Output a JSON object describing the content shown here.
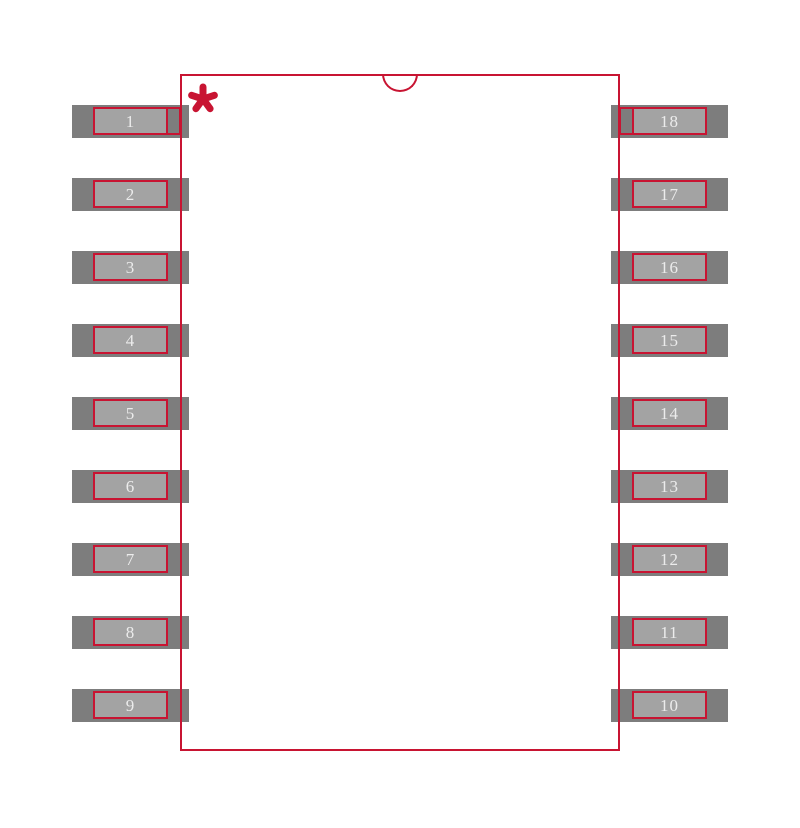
{
  "figure": {
    "kind": "ic-footprint-land-pattern",
    "description": "18-pin dual-row surface mount package footprint with index notch and pin 1 asterisk marker",
    "pin1_marker": "asterisk",
    "colors": {
      "outline_red": "#c81432",
      "pad_outer_gray": "#7d7d7d",
      "pad_inner_gray": "#a3a3a3",
      "pin_number_text": "#ececec",
      "background": "#ffffff"
    },
    "left_pins": [
      "1",
      "2",
      "3",
      "4",
      "5",
      "6",
      "7",
      "8",
      "9"
    ],
    "right_pins": [
      "18",
      "17",
      "16",
      "15",
      "14",
      "13",
      "12",
      "11",
      "10"
    ]
  }
}
